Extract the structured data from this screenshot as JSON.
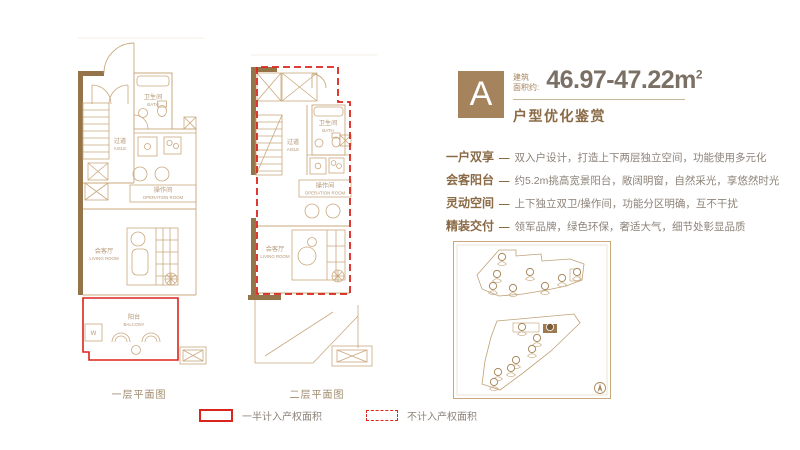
{
  "header": {
    "unit_letter": "A",
    "area_prefix_line1": "建筑",
    "area_prefix_line2": "面积约:",
    "area_value": "46.97-47.22m",
    "area_unit_sup": "2",
    "subtitle": "户型优化鉴赏"
  },
  "feature_separator": "—",
  "features": [
    {
      "keyword": "一户双享",
      "desc": "双入户设计，打造上下两层独立空间，功能使用多元化"
    },
    {
      "keyword": "会客阳台",
      "desc": "约5.2m挑高宽景阳台，敞阔明窗，自然采光，享悠然时光"
    },
    {
      "keyword": "灵动空间",
      "desc": "上下独立双卫/操作间，功能分区明确，互不干扰"
    },
    {
      "keyword": "精装交付",
      "desc": "领军品牌，绿色环保，奢适大气，细节处彰显品质"
    }
  ],
  "plans": [
    {
      "caption": "一层平面图",
      "rooms": {
        "bath_cn": "卫生间",
        "bath_en": "BATH",
        "aisle_cn": "过道",
        "aisle_en": "AISLE",
        "operation_cn": "操作间",
        "operation_en": "OPERATION ROOM",
        "living_cn": "会客厅",
        "living_en": "LIVING ROOM",
        "balcony_cn": "阳台",
        "balcony_en": "BALCONY"
      },
      "glyphs": {
        "washer": "W"
      }
    },
    {
      "caption": "二层平面图",
      "rooms": {
        "bath_cn": "卫生间",
        "bath_en": "BATH",
        "aisle_cn": "过道",
        "aisle_en": "AISLE",
        "operation_cn": "操作间",
        "operation_en": "OPERATION ROOM",
        "living_cn": "会客厅",
        "living_en": "LIVING ROOM"
      }
    }
  ],
  "legend": {
    "items": [
      {
        "style": "solid",
        "label": "一半计入产权面积"
      },
      {
        "style": "dashed",
        "label": "不计入产权面积"
      }
    ]
  },
  "colors": {
    "brand_brown": "#a5835c",
    "keyword_brown": "#8a6a45",
    "plan_line": "#c9a87e",
    "wall_fill": "#96744a",
    "highlight_red": "#da251c",
    "body_text": "#8d8379"
  }
}
